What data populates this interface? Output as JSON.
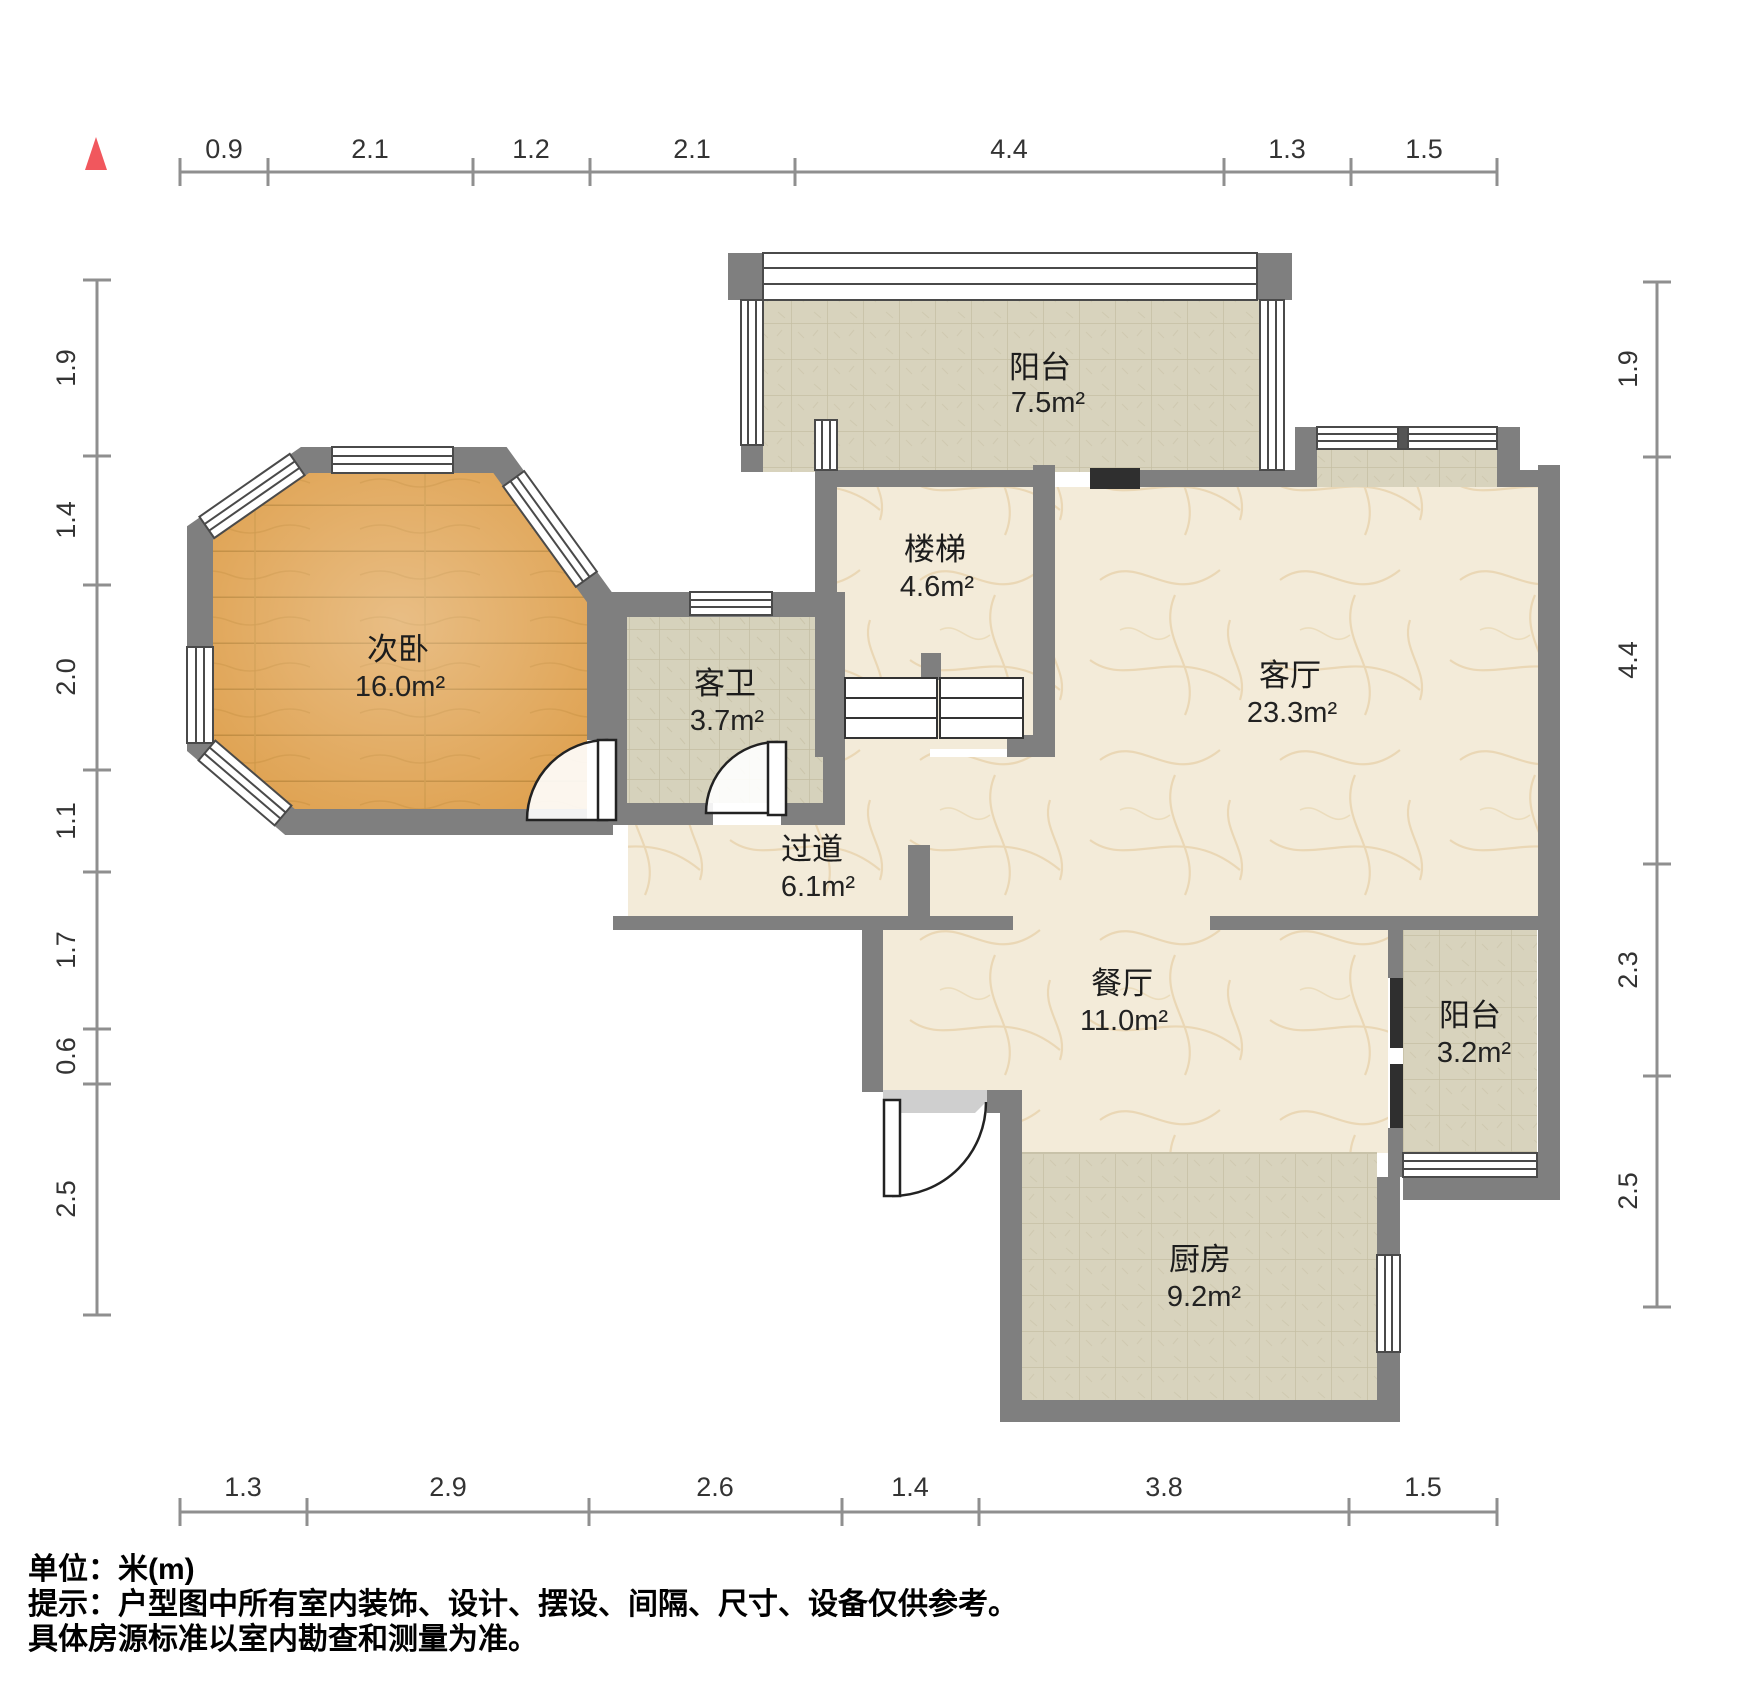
{
  "title": "户型图",
  "north_indicator": "north-triangle",
  "colors": {
    "wall": "#7f7f7f",
    "wood_floor": "#dfa251",
    "marble_floor": "#f3ebd9",
    "tile_floor": "#d8d3bd",
    "north_red": "#f1575d",
    "door_dark": "#2f2f2f"
  },
  "rulers": {
    "top": [
      "0.9",
      "2.1",
      "1.2",
      "2.1",
      "4.4",
      "1.3",
      "1.5"
    ],
    "bottom": [
      "1.3",
      "2.9",
      "2.6",
      "1.4",
      "3.8",
      "1.5"
    ],
    "left": [
      "1.9",
      "1.4",
      "2.0",
      "1.1",
      "1.7",
      "0.6",
      "2.5"
    ],
    "right": [
      "1.9",
      "4.4",
      "2.3",
      "2.5"
    ]
  },
  "rooms": {
    "balcony_top": {
      "name": "阳台",
      "area": "7.5m²"
    },
    "stairs": {
      "name": "楼梯",
      "area": "4.6m²"
    },
    "living": {
      "name": "客厅",
      "area": "23.3m²"
    },
    "bedroom": {
      "name": "次卧",
      "area": "16.0m²"
    },
    "bathroom": {
      "name": "客卫",
      "area": "3.7m²"
    },
    "hallway": {
      "name": "过道",
      "area": "6.1m²"
    },
    "dining": {
      "name": "餐厅",
      "area": "11.0m²"
    },
    "balcony_right": {
      "name": "阳台",
      "area": "3.2m²"
    },
    "kitchen": {
      "name": "厨房",
      "area": "9.2m²"
    }
  },
  "notes": {
    "unit": "单位：米(m)",
    "disclaimer1": "提示：户型图中所有室内装饰、设计、摆设、间隔、尺寸、设备仅供参考。",
    "disclaimer2": "具体房源标准以室内勘查和测量为准。"
  }
}
